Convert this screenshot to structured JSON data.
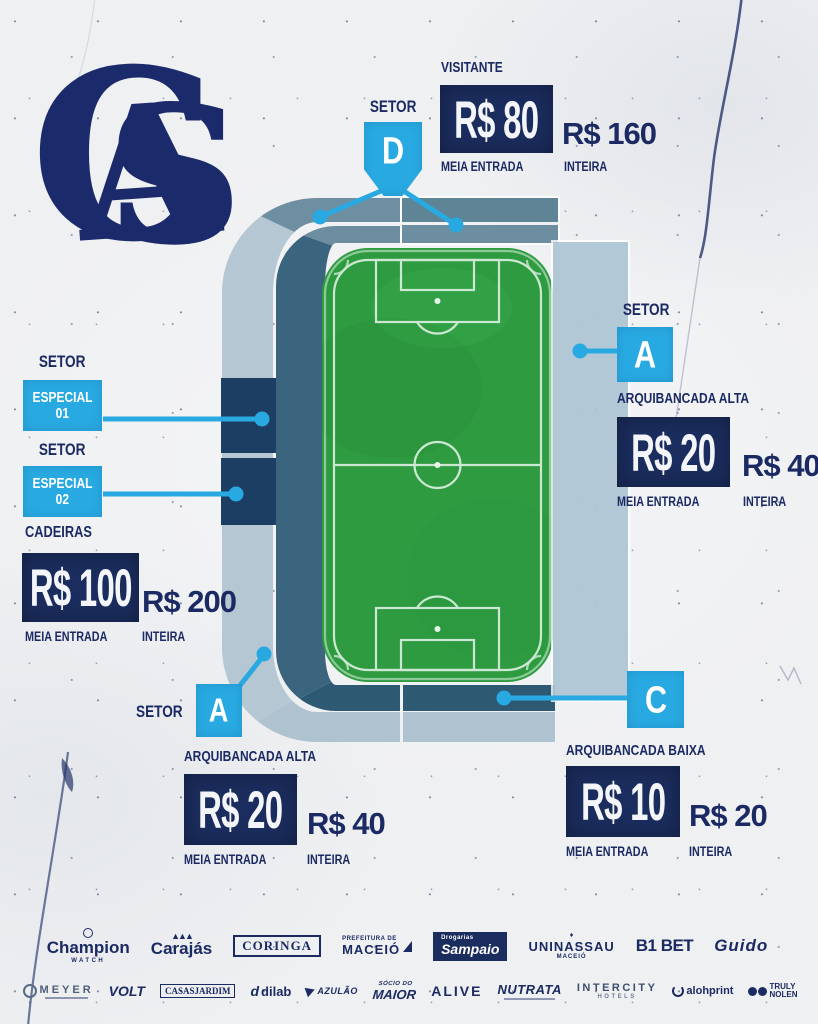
{
  "club": {
    "monogram_letters": "CSA"
  },
  "colors": {
    "accent_blue": "#29a9e1",
    "navy_text": "#1b2a63",
    "navy_box": "#1b2d5e",
    "pitch_green": "#2f9b41",
    "ring_outer": "#b5c7d2",
    "ring_inner": "#3b657e",
    "stand_slate": "#5f8496",
    "right_stand": "#aec5d4",
    "especial_navy": "#1d3e63"
  },
  "cards": {
    "visitante": {
      "setor": "SETOR",
      "letter": "D",
      "title": "VISITANTE",
      "half": "R$ 80",
      "half_label": "MEIA ENTRADA",
      "full": "R$ 160",
      "full_label": "INTEIRA"
    },
    "especial": {
      "setor1": "SETOR",
      "box1_line1": "ESPECIAL",
      "box1_line2": "01",
      "setor2": "SETOR",
      "box2_line1": "ESPECIAL",
      "box2_line2": "02",
      "title": "CADEIRAS",
      "half": "R$ 100",
      "half_label": "MEIA ENTRADA",
      "full": "R$ 200",
      "full_label": "INTEIRA"
    },
    "a_right": {
      "setor": "SETOR",
      "letter": "A",
      "title": "ARQUIBANCADA ALTA",
      "half": "R$ 20",
      "half_label": "MEIA ENTRADA",
      "full": "R$ 40",
      "full_label": "INTEIRA"
    },
    "a_bottom": {
      "setor": "SETOR",
      "letter": "A",
      "title": "ARQUIBANCADA ALTA",
      "half": "R$ 20",
      "half_label": "MEIA ENTRADA",
      "full": "R$ 40",
      "full_label": "INTEIRA"
    },
    "c_bottom": {
      "letter": "C",
      "title": "ARQUIBANCADA BAIXA",
      "half": "R$ 10",
      "half_label": "MEIA ENTRADA",
      "full": "R$ 20",
      "full_label": "INTEIRA"
    }
  },
  "sponsors": {
    "row1": [
      {
        "name": "Champion",
        "sub": "WATCH"
      },
      {
        "name": "Carajás"
      },
      {
        "name": "CORINGA"
      },
      {
        "name": "MACEIÓ",
        "sub": "PREFEITURA DE"
      },
      {
        "name": "Sampaio",
        "sub": "Drogarias"
      },
      {
        "name": "UNINASSAU",
        "sub": "MACEIÓ"
      },
      {
        "name": "B1 BET"
      },
      {
        "name": "Guido"
      }
    ],
    "row2": [
      {
        "name": "MEYER"
      },
      {
        "name": "VOLT"
      },
      {
        "name": "CASASJARDIM"
      },
      {
        "name": "dilab"
      },
      {
        "name": "AZULÃO"
      },
      {
        "name": "MAIOR",
        "sub": "SÓCIO DO"
      },
      {
        "name": "ALIVE"
      },
      {
        "name": "NUTRATA"
      },
      {
        "name": "INTERCITY",
        "sub": "HOTELS"
      },
      {
        "name": "alohprint"
      },
      {
        "name": "TRULY",
        "sub": "NOLEN"
      }
    ]
  }
}
